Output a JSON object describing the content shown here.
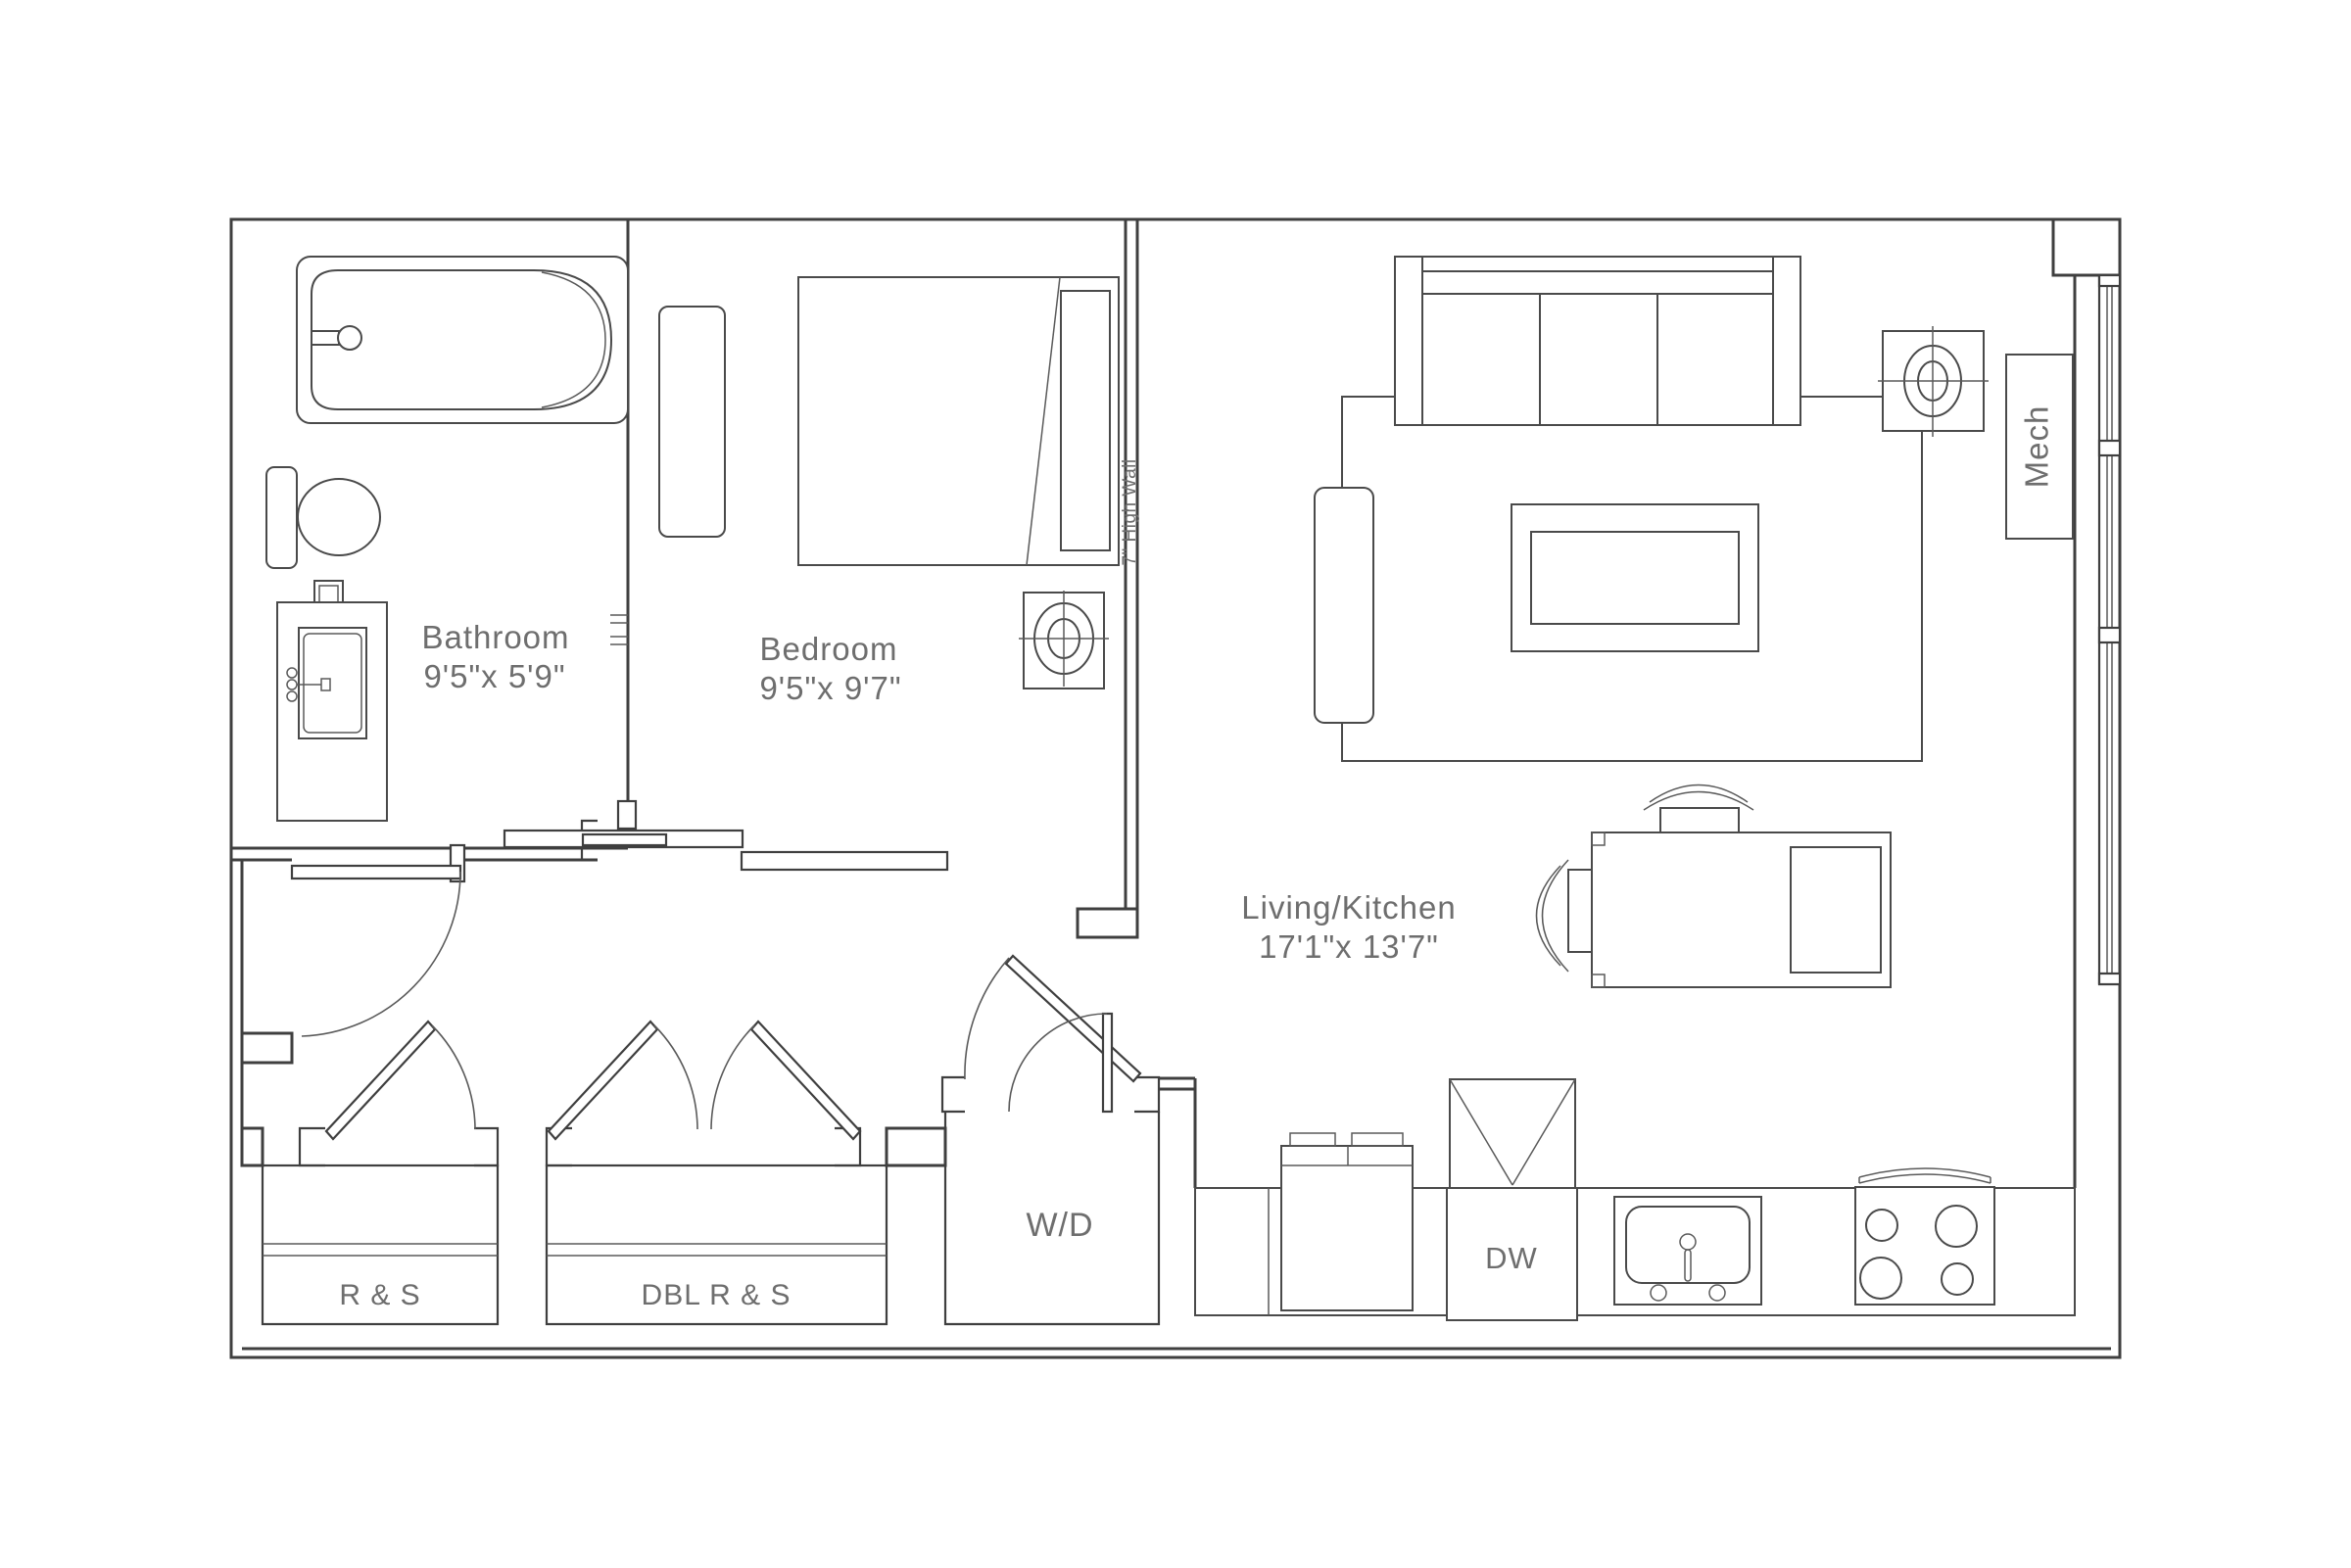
{
  "plan_title": "Studio / One-Bath Unit Floor Plan",
  "rooms": {
    "bathroom": {
      "name": "Bathroom",
      "dims": "9'5\"x 5'9\""
    },
    "bedroom": {
      "name": "Bedroom",
      "dims": "9'5\"x 9'7\""
    },
    "living_kitchen": {
      "name": "Living/Kitchen",
      "dims": "17'1\"x 13'7\""
    },
    "mech": {
      "name": "Mech"
    }
  },
  "closets": {
    "rs": "R & S",
    "dbl_rs": "DBL R & S"
  },
  "appliances": {
    "washer_dryer": "W/D",
    "dishwasher": "DW"
  },
  "annotations": {
    "high_wall": "7\" High Wall"
  },
  "colors": {
    "background": "#ffffff",
    "line": "#3f3f3f",
    "furniture_line": "#4a4a4a",
    "text": "#6e6e6e"
  }
}
